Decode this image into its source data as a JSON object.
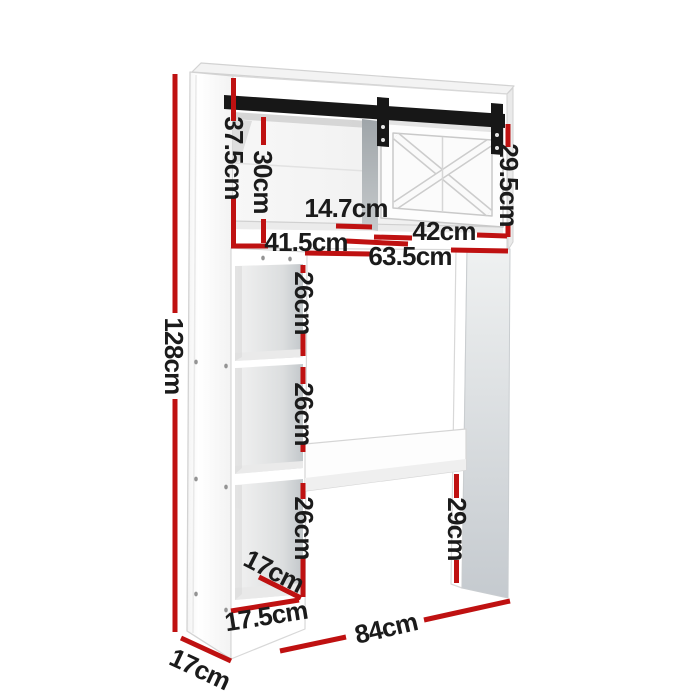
{
  "colors": {
    "dimension_red": "#bf1111",
    "rail_black": "#171717",
    "label_text": "#1b1b1b"
  },
  "dimensions": {
    "overall_height": "128cm",
    "top_left_height": "37.5cm",
    "top_inner_height": "30cm",
    "top_inner_depth": "14.7cm",
    "left_opening_width": "41.5cm",
    "door_width": "42cm",
    "middle_span_width": "63.5cm",
    "door_height": "29.5cm",
    "cube_height_top": "26cm",
    "cube_height_middle": "26cm",
    "cube_height_bottom": "26cm",
    "leg_gap_height": "29cm",
    "cube_depth": "17cm",
    "cube_width": "17.5cm",
    "side_depth": "17cm",
    "overall_width": "84cm"
  }
}
